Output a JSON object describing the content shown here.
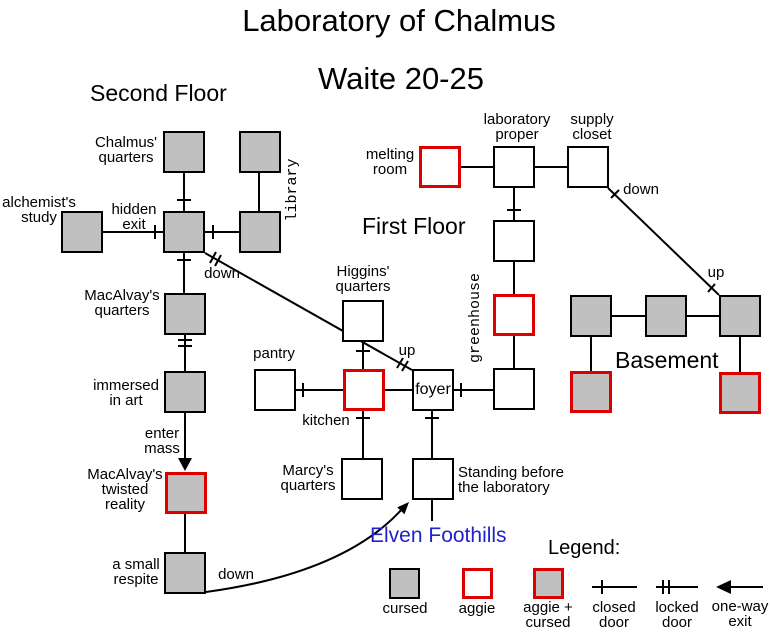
{
  "title": "Laboratory of Chalmus",
  "subtitle": "Waite 20-25",
  "floor_labels": {
    "second": "Second Floor",
    "first": "First Floor",
    "basement": "Basement"
  },
  "exterior_label": "Elven Foothills",
  "rooms": {
    "chalmus_quarters": "Chalmus'\nquarters",
    "alchemists_study": "alchemist's\nstudy",
    "library": "library",
    "macalvays_quarters": "MacAlvay's\nquarters",
    "immersed_in_art": "immersed\nin art",
    "macalvays_twisted_reality": "MacAlvay's\ntwisted\nreality",
    "a_small_respite": "a small\nrespite",
    "melting_room": "melting\nroom",
    "laboratory_proper": "laboratory\nproper",
    "supply_closet": "supply\ncloset",
    "greenhouse": "greenhouse",
    "higgins_quarters": "Higgins'\nquarters",
    "pantry": "pantry",
    "kitchen": "kitchen",
    "foyer": "foyer",
    "marcys_quarters": "Marcy's\nquarters",
    "standing_before_laboratory": "Standing before\nthe laboratory"
  },
  "exit_labels": {
    "hidden_exit": "hidden\nexit",
    "second_floor_down": "down",
    "foyer_up": "up",
    "enter_mass": "enter\nmass",
    "respite_down": "down",
    "closet_down": "down",
    "basement_up": "up"
  },
  "legend": {
    "heading": "Legend:",
    "cursed": "cursed",
    "aggie": "aggie",
    "aggie_cursed": "aggie +\ncursed",
    "closed_door": "closed\ndoor",
    "locked_door": "locked\ndoor",
    "one_way_exit": "one-way\nexit"
  },
  "colors": {
    "cursed_fill": "#c0c0c0",
    "aggie_border": "#dd0000",
    "exterior_text": "#2222cc",
    "line": "#000000"
  }
}
